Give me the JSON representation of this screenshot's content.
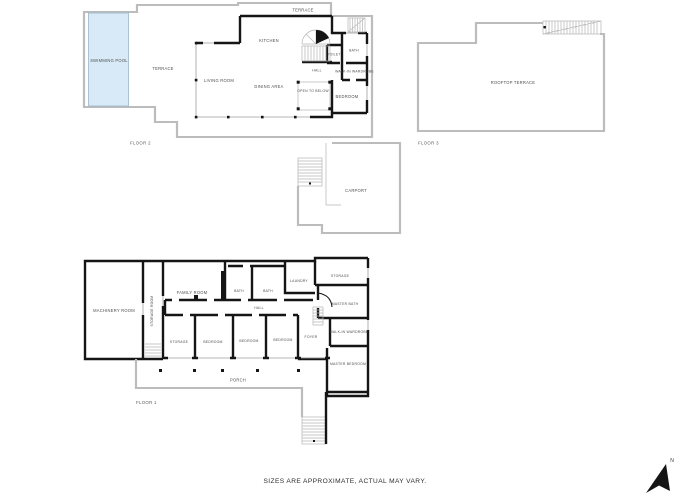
{
  "colors": {
    "wall": "#151515",
    "outline_gray": "#bcbcbc",
    "pool_fill": "#d8eaf7",
    "pool_border": "#96b6ca",
    "label_text": "#4c4c4c"
  },
  "floor2": {
    "label": "FLOOR 2",
    "rooms": {
      "swimming_pool": "SWIMMING POOL",
      "terrace": "TERRACE",
      "terrace_top": "TERRACE",
      "living_room": "LIVING ROOM",
      "dining_area": "DINING AREA",
      "kitchen": "KITCHEN",
      "toilet": "TOILET",
      "bath": "BATH",
      "hall": "HALL",
      "walk_in_wardrobe": "WALK-IN WARDROBE",
      "open_to_below": "OPEN TO BELOW",
      "bedroom": "BEDROOM"
    }
  },
  "courtyard": {
    "rooms": {
      "carport": "CARPORT"
    }
  },
  "floor3": {
    "label": "FLOOR 3",
    "rooms": {
      "rooftop_terrace": "ROOFTOP TERRACE"
    }
  },
  "floor1": {
    "label": "FLOOR 1",
    "rooms": {
      "machinery_room": "MACHINERY ROOM",
      "storage_room": "STORAGE ROOM",
      "family_room": "FAMILY ROOM",
      "bath_1": "BATH",
      "bath_2": "BATH",
      "laundry": "LAUNDRY",
      "storage": "STORAGE",
      "hall": "HALL",
      "master_bath": "MASTER BATH",
      "walk_in_wardrobe": "WALK-IN WARDROBE",
      "foyer": "FOYER",
      "storage_2": "STORAGE",
      "bedroom_1": "BEDROOM",
      "bedroom_2": "BEDROOM",
      "bedroom_3": "BEDROOM",
      "master_bedroom": "MASTER BEDROOM",
      "porch": "PORCH"
    }
  },
  "footer": {
    "disclaimer": "SIZES ARE APPROXIMATE, ACTUAL MAY VARY."
  },
  "compass": {
    "label": "N"
  }
}
